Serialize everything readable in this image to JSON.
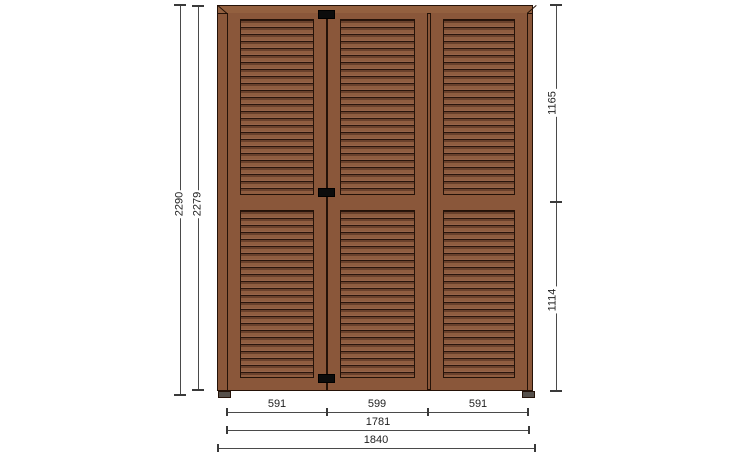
{
  "drawing": {
    "subject": "Three-leaf louvered shutter door - dimensioned elevation",
    "leaf_count": "3",
    "colors": {
      "background": "#ffffff",
      "wood": "#8a573a",
      "wood_light": "#93603f",
      "louver_shadow": "#6a412c",
      "louver_face": "#8f5d40",
      "outline": "#241208",
      "hinge": "#0c0c0c",
      "foot": "#55504b",
      "dimension_line": "#4a4a4a",
      "dimension_text": "#1f1f1f"
    }
  },
  "dims": {
    "left_overall_height": "2290",
    "left_leaf_height": "2279",
    "right_upper_height": "1165",
    "right_lower_height": "1114",
    "bottom_segments": [
      "591",
      "599",
      "591"
    ],
    "bottom_leaves_width": "1781",
    "bottom_overall_width": "1840"
  }
}
